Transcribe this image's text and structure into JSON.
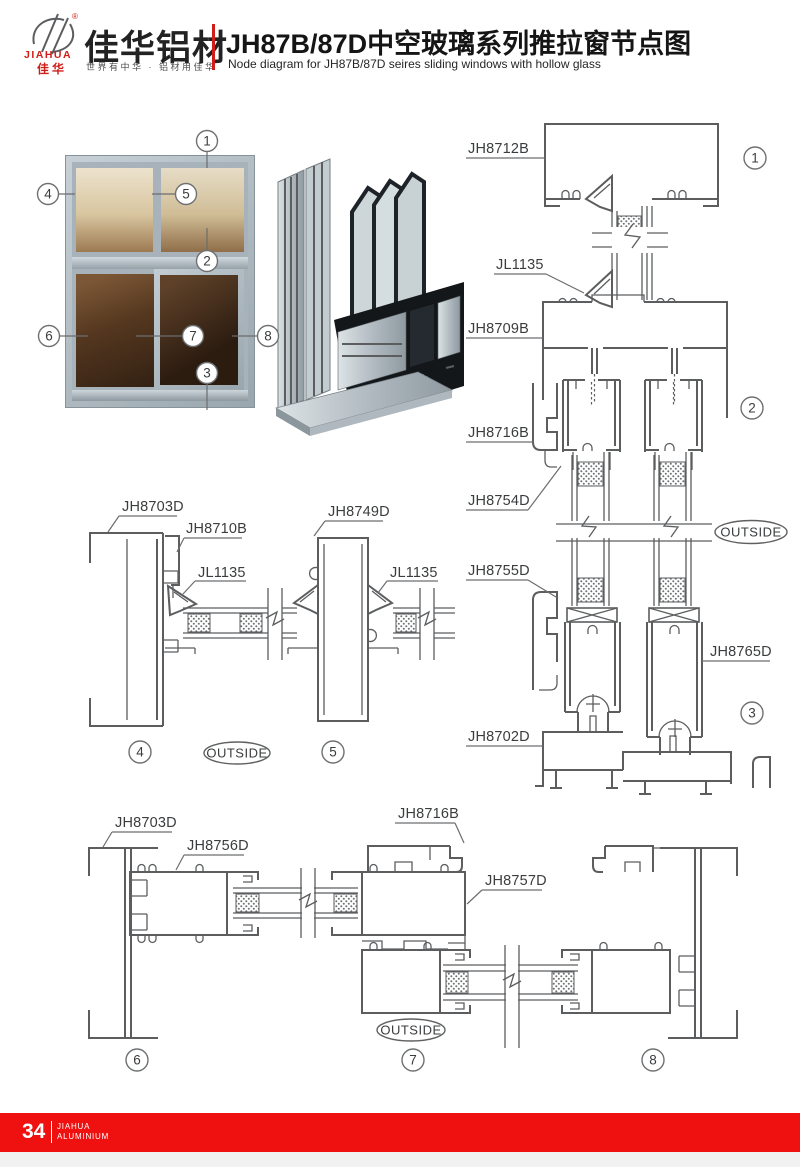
{
  "header": {
    "brand_cn": "佳华铝材",
    "brand_reg": "®",
    "logo_en": "JIAHUA",
    "logo_cn": "佳华",
    "slogan": "世界有中华 · 铝材用佳华",
    "title_cn": "JH87B/87D中空玻璃系列推拉窗节点图",
    "title_en": "Node diagram for JH87B/87D seires sliding windows with hollow glass"
  },
  "callouts": {
    "c1": "1",
    "c2": "2",
    "c3": "3",
    "c4": "4",
    "c5": "5",
    "c6": "6",
    "c7": "7",
    "c8": "8"
  },
  "labels": {
    "jh8712b": "JH8712B",
    "jl1135": "JL1135",
    "jh8709b": "JH8709B",
    "jh8716b": "JH8716B",
    "jh8754d": "JH8754D",
    "jh8755d": "JH8755D",
    "jh8765d": "JH8765D",
    "jh8702d": "JH8702D",
    "jh8703d": "JH8703D",
    "jh8710b": "JH8710B",
    "jh8749d": "JH8749D",
    "jh8756d": "JH8756D",
    "jh8757d": "JH8757D",
    "outside": "OUTSIDE"
  },
  "footer": {
    "page": "34",
    "brand_line1": "JIAHUA",
    "brand_line2": "ALUMINIUM"
  },
  "colors": {
    "accent_red": "#ef1010",
    "logo_red": "#cf1d18",
    "line_gray": "#5b5d5f",
    "label_text": "#3a3c3e"
  }
}
